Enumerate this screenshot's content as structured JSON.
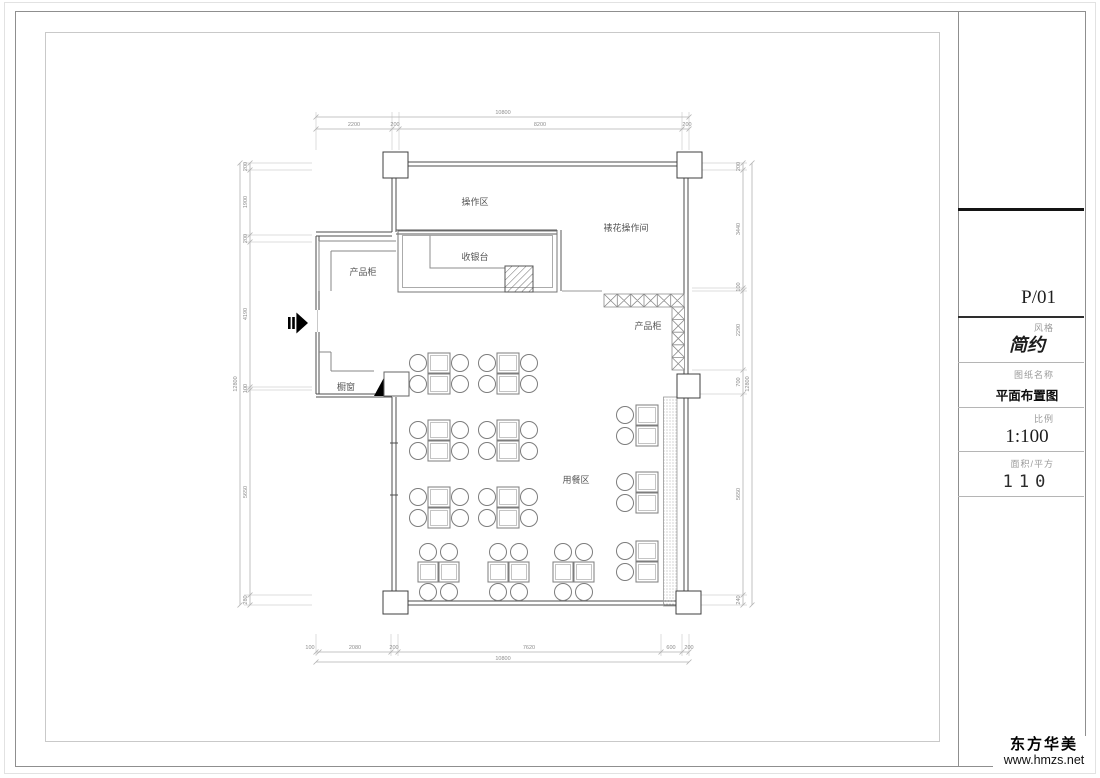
{
  "watermark": {
    "name": "东方华美",
    "url": "www.hmzs.net"
  },
  "title_block": {
    "code": "P/01",
    "style_label": "风格",
    "style_value": "简约",
    "drawing_label": "图纸名称",
    "drawing_value": "平面布置图",
    "scale_label": "比例",
    "scale_value": "1:100",
    "area_label": "面积/平方",
    "area_value": "110"
  },
  "plan": {
    "labels": {
      "operation_area": "操作区",
      "decorating_room": "裱花操作间",
      "cashier": "收银台",
      "product_cabinet_left": "产品柜",
      "product_cabinet_right": "产品柜",
      "display_window": "橱窗",
      "dining_area": "用餐区"
    },
    "dims": {
      "top": {
        "total": "10800",
        "segs": [
          "2200",
          "200",
          "8200",
          "200"
        ]
      },
      "bottom": {
        "total": "10800",
        "segs": [
          "100",
          "2080",
          "200",
          "7620",
          "600",
          "200"
        ]
      },
      "left": {
        "total": "12800",
        "segs": [
          "200",
          "1900",
          "200",
          "4190",
          "100",
          "5650",
          "280"
        ]
      },
      "right": {
        "total": "12800",
        "segs": [
          "200",
          "3440",
          "100",
          "2290",
          "700",
          "5650",
          "240"
        ]
      }
    }
  }
}
